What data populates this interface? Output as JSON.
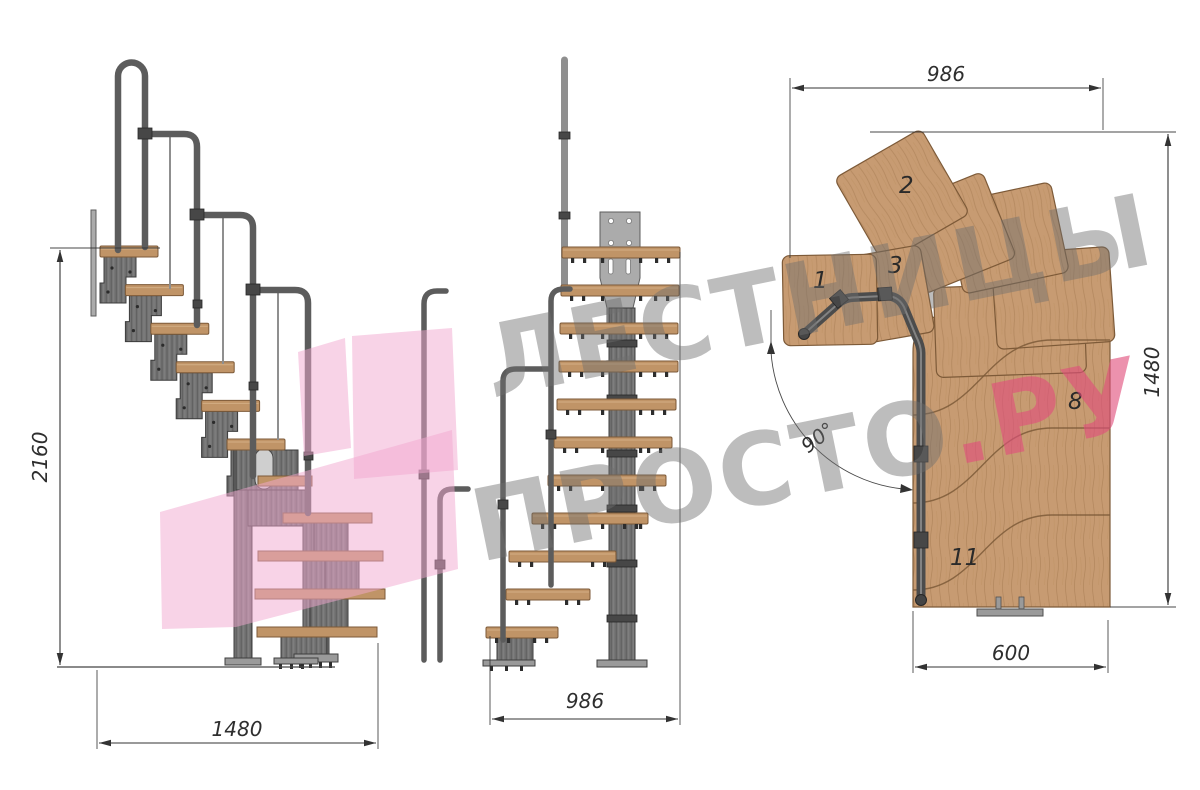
{
  "watermark": {
    "line1": "ЛЕСТНИЦЫ",
    "line2": "ПРОСТО",
    "tld": ".РУ"
  },
  "side_view": {
    "height_label": "2160",
    "width_label": "1480"
  },
  "front_view": {
    "width_label": "986"
  },
  "plan_view": {
    "top_label": "986",
    "right_label": "1480",
    "bottom_label": "600",
    "angle_label": "90°",
    "steps": {
      "s1": "1",
      "s2": "2",
      "s3": "3",
      "s8": "8",
      "s11": "11"
    }
  },
  "colors": {
    "bg": "#ffffff",
    "wood": "#c79b72",
    "wood_side": "#c09467",
    "wood_edge": "#7d5a38",
    "metal": "#757575",
    "metal_dark": "#3c3c3c",
    "metal_light": "#9a9a9a",
    "rail": "#5c5c5c",
    "plate": "#ababab",
    "dim": "#333333",
    "wm_shape": "#f1a8cf",
    "wm_gray": "#6f6f6f",
    "wm_pink": "#e14e7c"
  }
}
